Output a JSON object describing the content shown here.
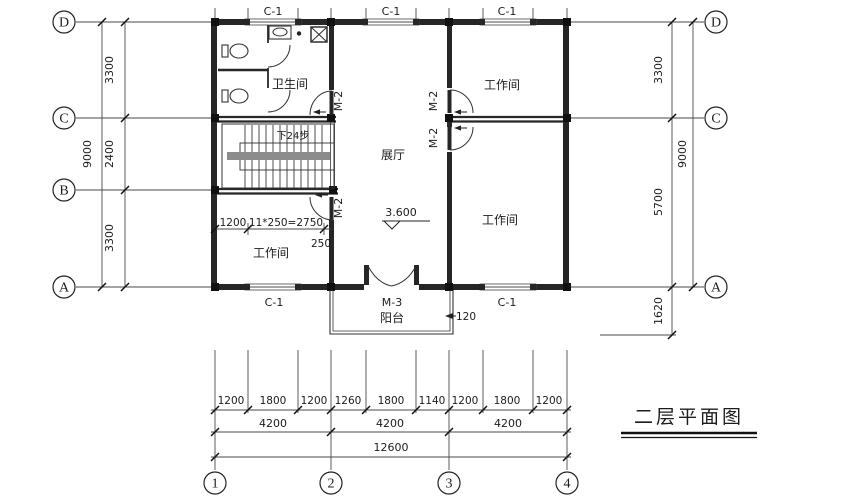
{
  "title": {
    "text": "二层平面图"
  },
  "axes": {
    "left": [
      "D",
      "C",
      "B",
      "A"
    ],
    "right": [
      "D",
      "C",
      "A"
    ],
    "bottom": [
      "1",
      "2",
      "3",
      "4"
    ]
  },
  "dims": {
    "left": {
      "segments": [
        "3300",
        "2400",
        "3300"
      ],
      "overall": "9000"
    },
    "right": {
      "segments": [
        "3300",
        "5700"
      ],
      "overall": "9000",
      "balcony": "1620"
    },
    "bottom": {
      "detail": [
        "1200",
        "1800",
        "1200",
        "1260",
        "1800",
        "1140",
        "1200",
        "1800",
        "1200"
      ],
      "bays": [
        "4200",
        "4200",
        "4200"
      ],
      "overall": "12600"
    },
    "stair": {
      "start": "1200",
      "run": "11*250=2750",
      "offset": "250"
    },
    "balcony_offset": "120"
  },
  "openings": {
    "window": "C-1",
    "door": "M-2",
    "balcony_door": "M-3"
  },
  "rooms": {
    "bathroom": "卫生间",
    "workshop": "工作间",
    "hall": "展厅",
    "balcony": "阳台"
  },
  "stair_note": "下24步",
  "elevation": "3.600",
  "colors": {
    "wall": "#262626",
    "line": "#2b2b2b",
    "stair_band": "#8c8c8c",
    "background": "#ffffff"
  }
}
